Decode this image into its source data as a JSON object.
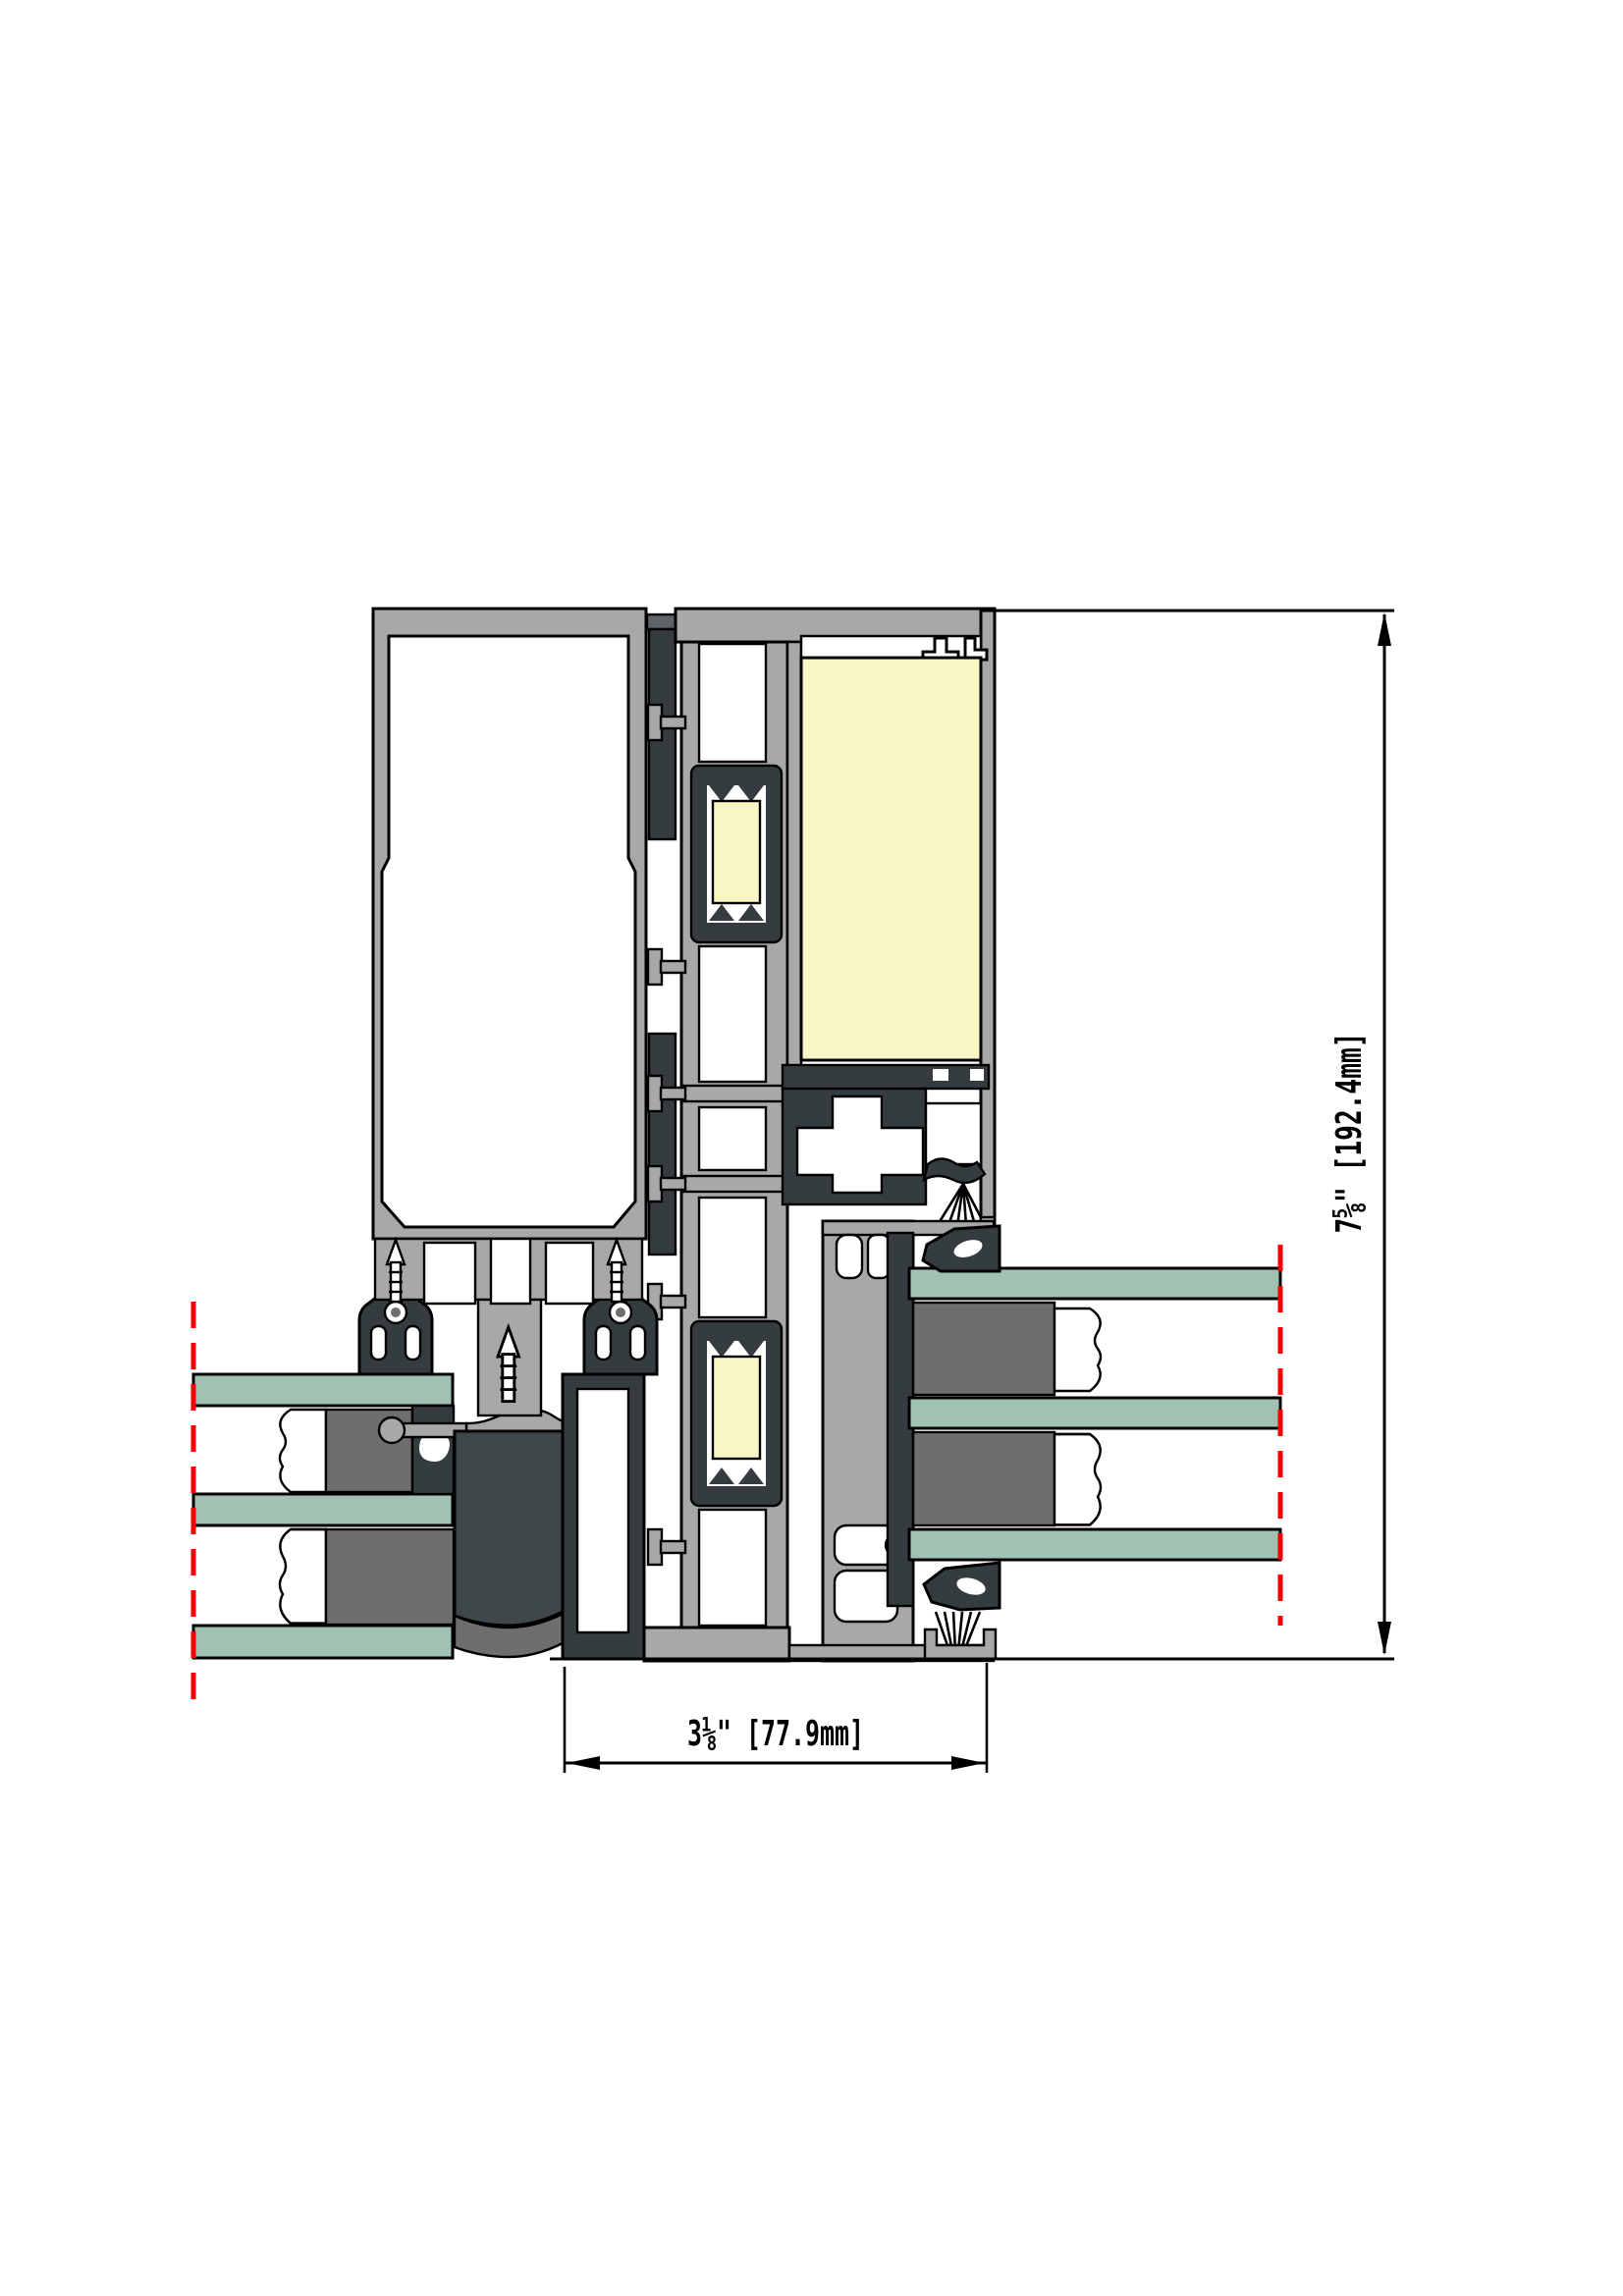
{
  "dimensions": {
    "overall_height": {
      "text": "7⅝\" [192.4mm]"
    },
    "frame_width": {
      "text": "3⅛\" [77.9mm]"
    }
  },
  "colors": {
    "aluminum": "#a8a8a8",
    "aluminum-dark": "#5d6366",
    "gasket": "#353c3f",
    "block": "#40474a",
    "spacer": "#6e6e6e",
    "insulation": "#f9f6c5",
    "glass": "#a1c2b2",
    "centerline": "#f40000",
    "line": "#000000",
    "background": "#ffffff"
  }
}
